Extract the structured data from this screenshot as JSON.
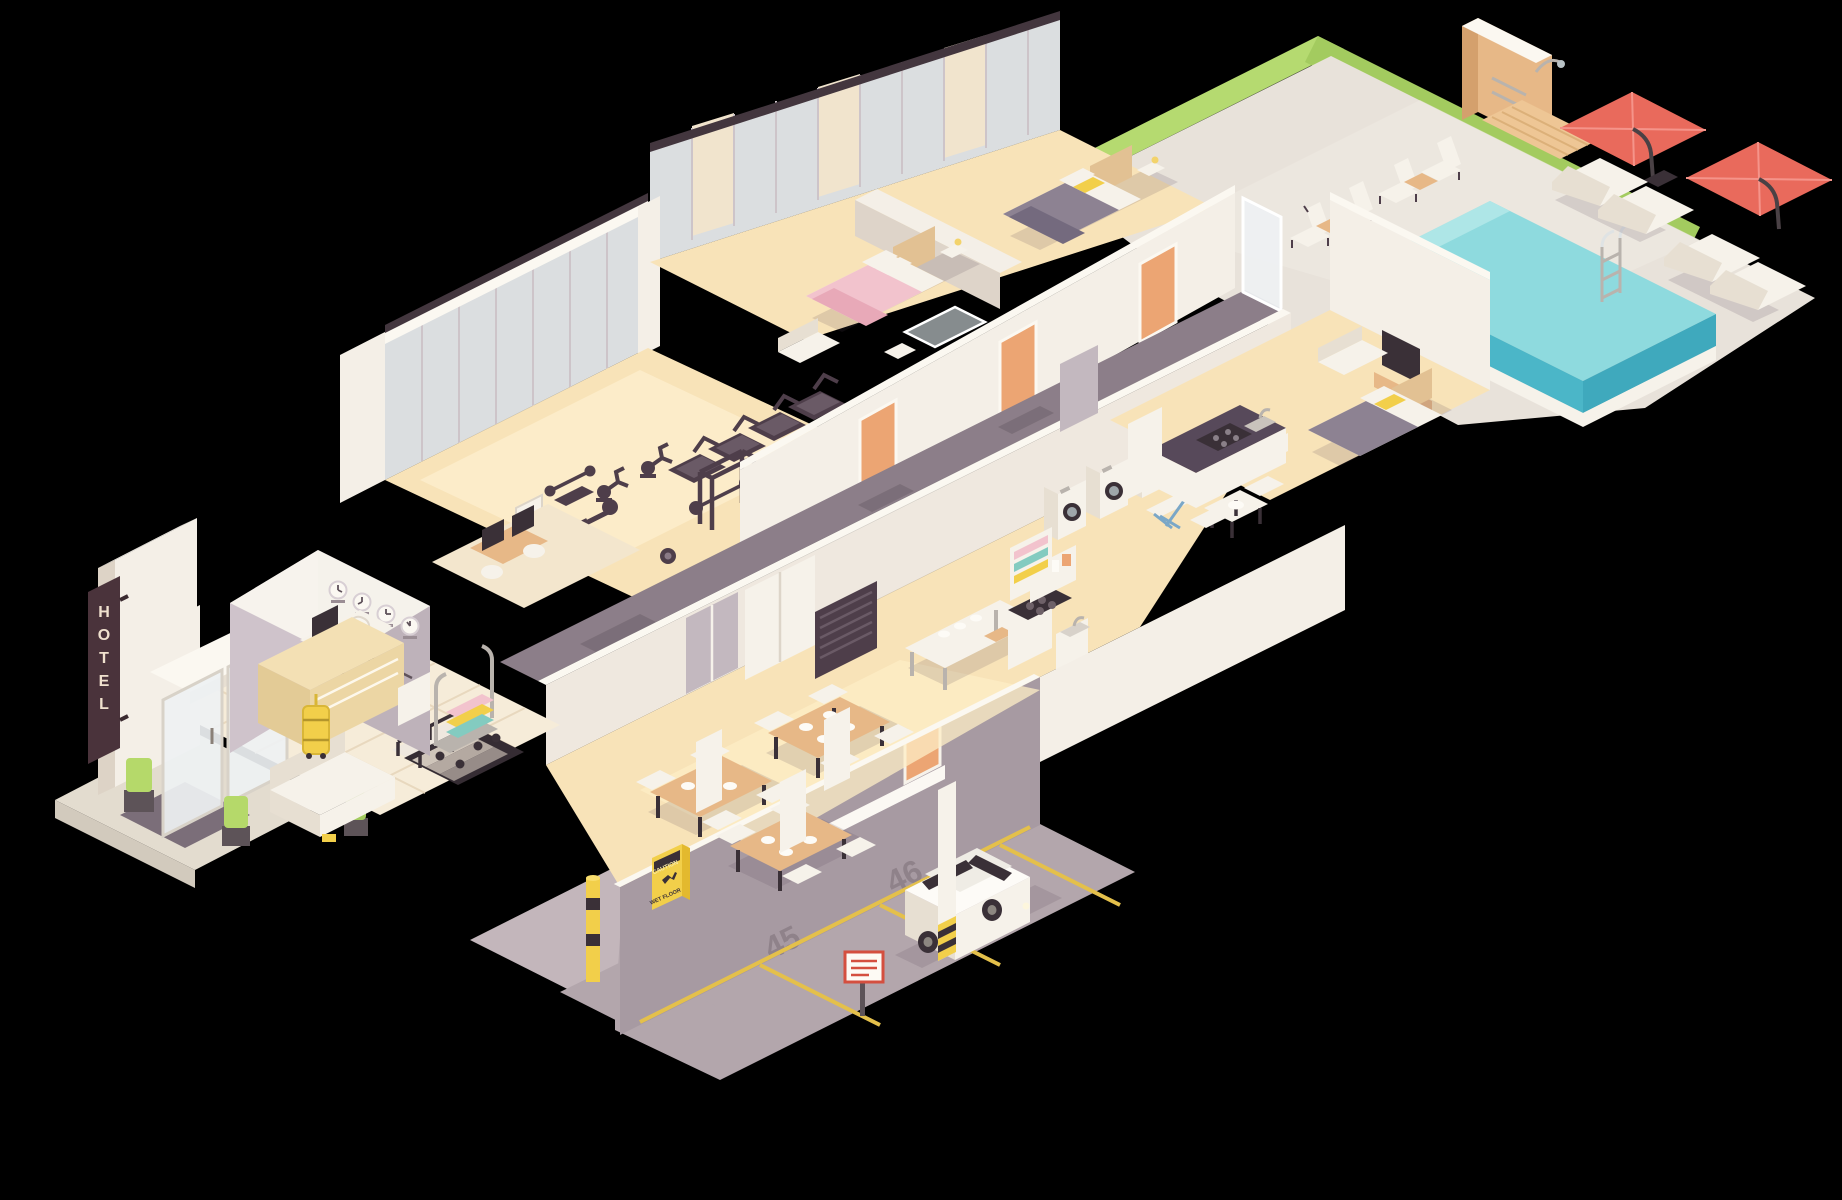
{
  "scene": {
    "description": "Isometric low-poly cutaway illustration of a hotel building with pool terrace and underground parking",
    "background_color": "#000000"
  },
  "signs": {
    "entrance_vertical_sign": {
      "letters": [
        "H",
        "O",
        "T",
        "E",
        "L"
      ],
      "board_color": "#4a333b",
      "letter_color": "#f0e1ce"
    },
    "reception_wall_sign": {
      "text": "HOTEL",
      "stars": "★ ★ ★",
      "world_clocks_count": 4
    },
    "wet_floor_sign": {
      "line1": "CAUTION",
      "line2": "WET FLOOR",
      "color": "#f2cf4a"
    },
    "parking": {
      "stall_numbers": [
        "45",
        "46"
      ],
      "stencil_color": "#8f828a",
      "exit_sign_color": "#55b054"
    }
  },
  "areas": [
    "entrance",
    "lobby",
    "reception",
    "back-office",
    "gym",
    "guest-room-1",
    "guest-room-2",
    "bathrooms",
    "corridor",
    "restaurant",
    "kitchen",
    "laundry",
    "suite",
    "parking-garage",
    "pool-terrace",
    "outdoor-shower"
  ],
  "palette": {
    "floor_sunlit": "#f8e3b8",
    "wall_light": "#f4efe7",
    "corridor_floor": "#8c7e89",
    "garage_wall": "#a79aa2",
    "pool_water": "#8edade",
    "pool_water_deep": "#4bb6c8",
    "grass": "#b5da70",
    "umbrella_red": "#e96a5c",
    "door_orange": "#eca573",
    "accent_yellow": "#f2cf4a",
    "gym_equipment": "#4e3e4a"
  }
}
